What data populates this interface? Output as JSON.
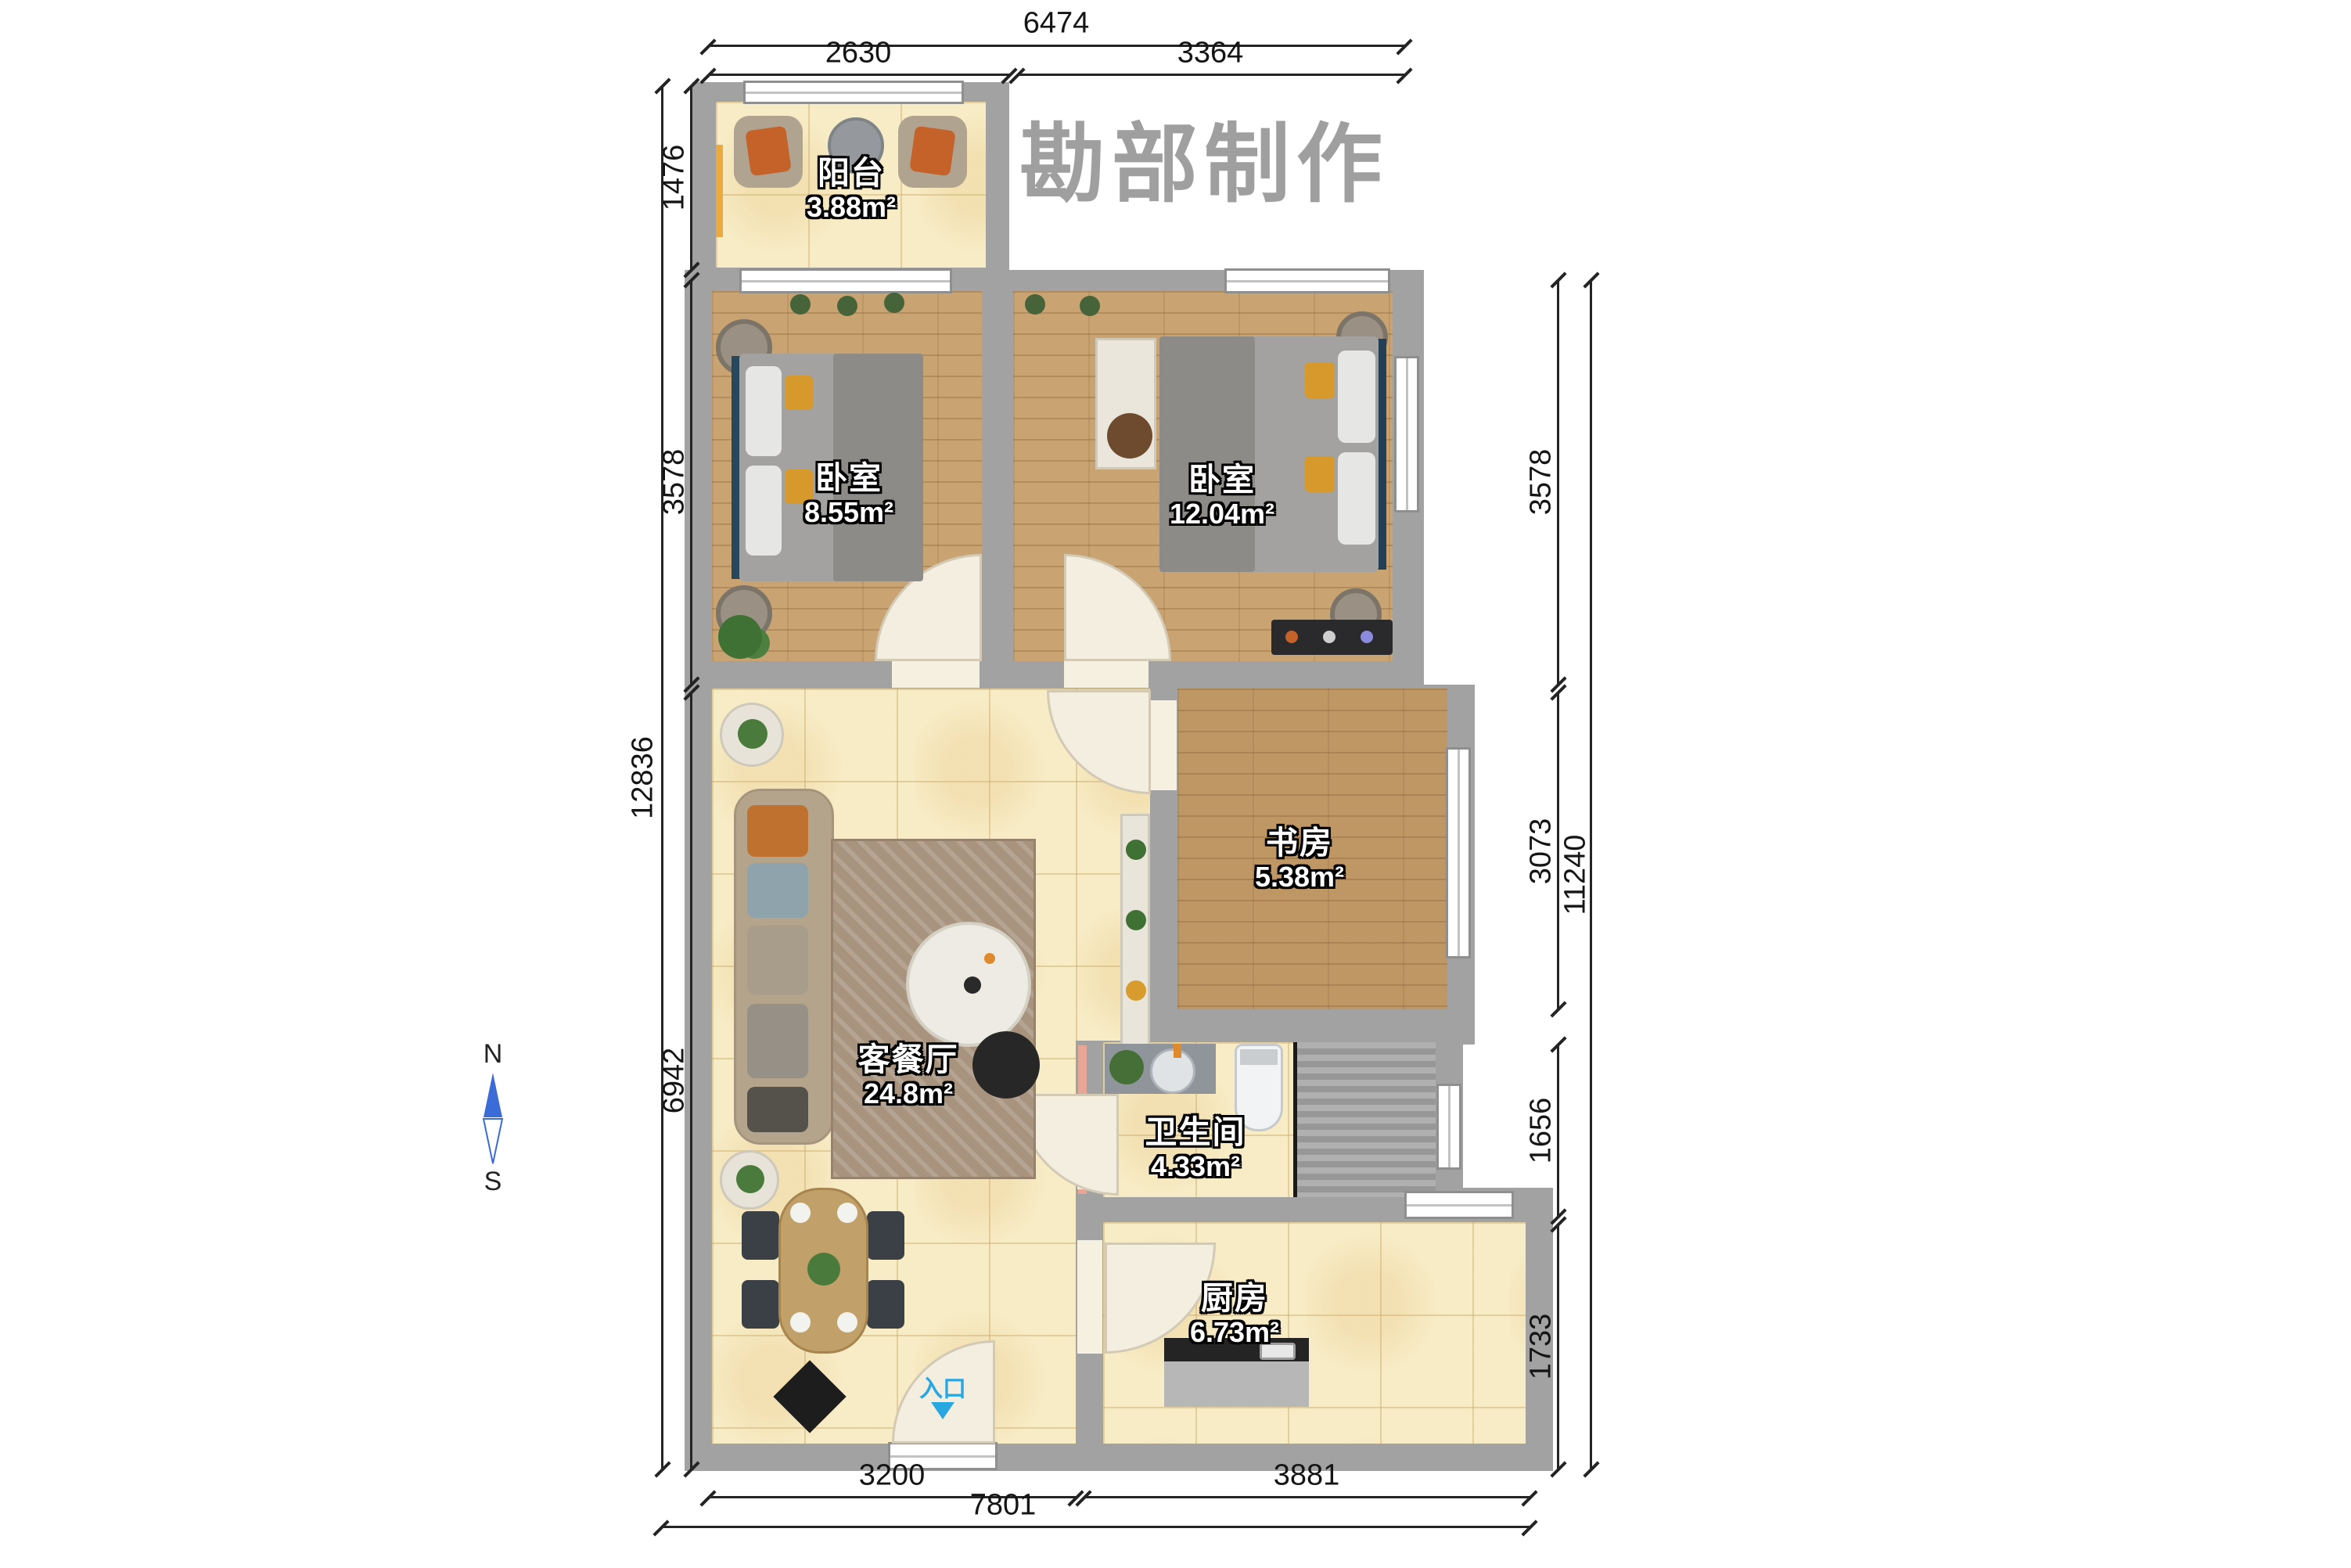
{
  "watermark": {
    "text": "房勘部制作"
  },
  "rooms": [
    {
      "id": "balcony",
      "name": "阳台",
      "area": "3.88m²"
    },
    {
      "id": "bedroom-small",
      "name": "卧室",
      "area": "8.55m²"
    },
    {
      "id": "bedroom-large",
      "name": "卧室",
      "area": "12.04m²"
    },
    {
      "id": "study",
      "name": "书房",
      "area": "5.38m²"
    },
    {
      "id": "living-dining",
      "name": "客餐厅",
      "area": "24.8m²"
    },
    {
      "id": "bathroom",
      "name": "卫生间",
      "area": "4.33m²"
    },
    {
      "id": "kitchen",
      "name": "厨房",
      "area": "6.73m²"
    }
  ],
  "dims": {
    "top": [
      "6474",
      "2630",
      "3364"
    ],
    "left": [
      "1476",
      "3578",
      "6942",
      "12836"
    ],
    "right": [
      "3578",
      "3073",
      "11240",
      "1656",
      "1733"
    ],
    "bottom": [
      "3200",
      "3881",
      "7801"
    ]
  },
  "entrance": {
    "label": "入口"
  },
  "compass": {
    "north": "N",
    "south": "S"
  },
  "colors": {
    "wall": "#a2a2a2",
    "tile_floor": "#f7ecc6",
    "wood_floor": "#c9a371",
    "entrance_accent": "#29a7e1",
    "compass_north": "#3a6bd6",
    "dimension_text": "#151515",
    "watermark": "#9f9f9f"
  }
}
